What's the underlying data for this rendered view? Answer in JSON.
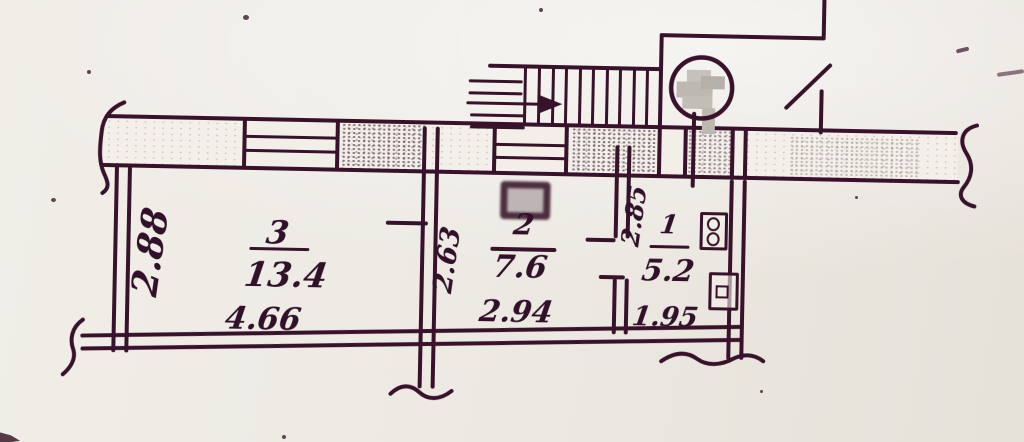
{
  "plan": {
    "rooms": [
      {
        "number": "3",
        "area": "13.4",
        "bottom_dim": "4.66"
      },
      {
        "number": "2",
        "area": "7.6",
        "bottom_dim": "2.94"
      },
      {
        "number": "1",
        "area": "5.2",
        "bottom_dim": "1.95"
      }
    ],
    "side_dims": {
      "left_wall": "2.88",
      "room2_left_wall": "2.63",
      "room1_left_wall": "2.85"
    }
  },
  "colors": {
    "ink": "#38122a",
    "paper": "#edeae4",
    "redaction_gray": "#bdb8b2"
  }
}
